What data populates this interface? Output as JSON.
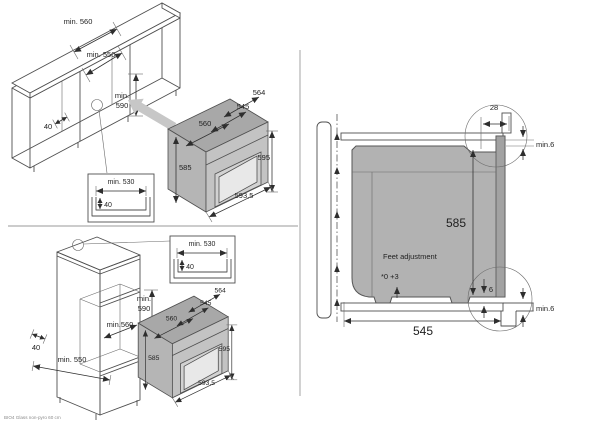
{
  "colors": {
    "line": "#4f4f4f",
    "oven_body": "#b2b2b2",
    "oven_top": "#a8a8a8",
    "oven_door": "#c3c3c3",
    "oven_window": "#e8e8e8",
    "section_fill": "#b2b2b2"
  },
  "footer": {
    "note": "BIO4 Glass non-pyro 60 cm"
  },
  "built_under": {
    "cabinet": {
      "width_top": "min. 560",
      "width_inner": "min. 550",
      "niche_height_line1": "min.",
      "niche_height_line2": "590",
      "plinth_depth": "40"
    },
    "recess_detail": {
      "width": "min. 530",
      "depth": "40"
    },
    "oven": {
      "depth_incl_door": "564",
      "depth": "545",
      "width_top": "560",
      "height_left": "585",
      "height_right": "595",
      "width_front": "593,5"
    }
  },
  "column": {
    "cabinet": {
      "niche_height_line1": "min.",
      "niche_height_line2": "590",
      "niche_width": "min.560",
      "plinth_depth": "40",
      "depth": "min. 550"
    },
    "recess_detail": {
      "width": "min. 530",
      "depth": "40"
    },
    "oven": {
      "depth_incl_door": "564",
      "depth": "545",
      "width_top": "560",
      "height_left": "585",
      "height_right": "595",
      "width_front": "593,5"
    }
  },
  "section": {
    "flange_width": "28",
    "top_clearance": "min.6",
    "niche_height": "585",
    "feet_note_title": "Feet adjustment",
    "feet_note_range": "*0 +3",
    "rear_clearance": "6",
    "bottom_clearance": "min.6",
    "depth": "545"
  }
}
